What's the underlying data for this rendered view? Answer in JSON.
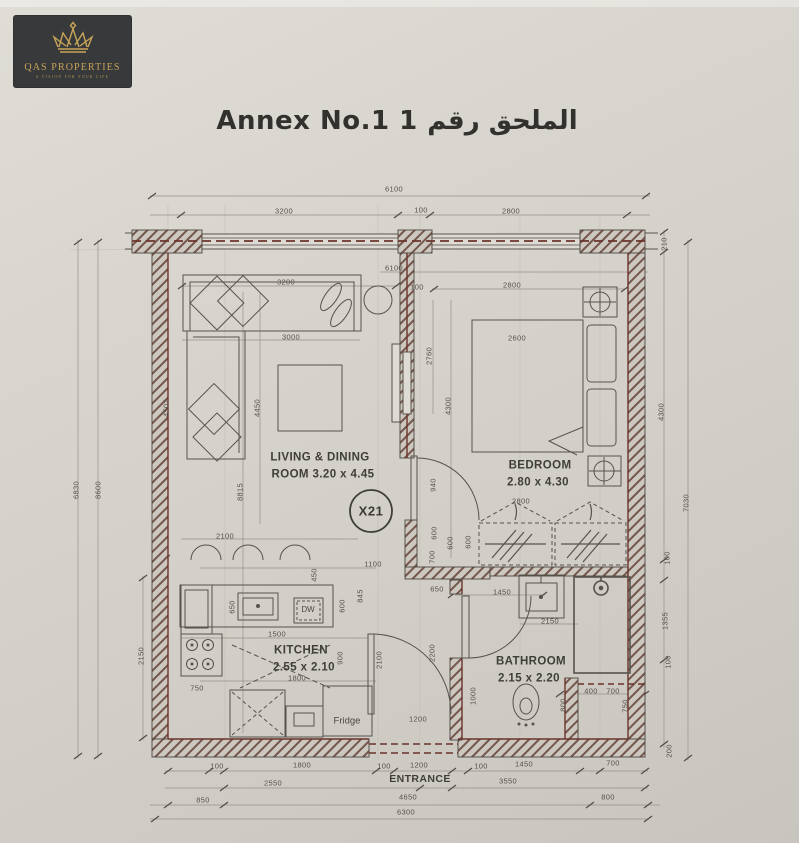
{
  "logo": {
    "name": "QAS PROPERTIES",
    "tagline": "A VISION FOR YOUR LIFE"
  },
  "title": "Annex No.1 1 الملحق رقم",
  "plan": {
    "unit_badge": "X21",
    "rooms": {
      "living": {
        "line1": "LIVING & DINING",
        "line2": "ROOM 3.20 x 4.45"
      },
      "bedroom": {
        "line1": "BEDROOM",
        "line2": "2.80 x 4.30"
      },
      "kitchen": {
        "line1": "KITCHEN",
        "line2": "2.55 x 2.10"
      },
      "bathroom": {
        "line1": "BATHROOM",
        "line2": "2.15 x 2.20"
      },
      "entrance": {
        "line1": "ENTRANCE"
      }
    },
    "appliances": {
      "dishwasher": "DW",
      "fridge": "Fridge"
    },
    "colors": {
      "paper": "#d5d2ca",
      "ink": "#4e4c46",
      "wall_accent": "#6b332b",
      "gold": "#c8a458",
      "logo_bg": "#37393b"
    },
    "dim_labels": [
      {
        "t": "6100",
        "x": 394,
        "y": 189
      },
      {
        "t": "3200",
        "x": 284,
        "y": 211
      },
      {
        "t": "100",
        "x": 421,
        "y": 210
      },
      {
        "t": "2800",
        "x": 511,
        "y": 211
      },
      {
        "t": "6830",
        "x": 76,
        "y": 490,
        "r": 1
      },
      {
        "t": "8600",
        "x": 98,
        "y": 490,
        "r": 1
      },
      {
        "t": "4502",
        "x": 166,
        "y": 408,
        "r": 1
      },
      {
        "t": "2150",
        "x": 141,
        "y": 656,
        "r": 1
      },
      {
        "t": "210",
        "x": 664,
        "y": 244,
        "r": 1
      },
      {
        "t": "4300",
        "x": 661,
        "y": 412,
        "r": 1
      },
      {
        "t": "7030",
        "x": 686,
        "y": 503,
        "r": 1
      },
      {
        "t": "100",
        "x": 667,
        "y": 558,
        "r": 1
      },
      {
        "t": "1355",
        "x": 665,
        "y": 621,
        "r": 1
      },
      {
        "t": "100",
        "x": 668,
        "y": 662,
        "r": 1
      },
      {
        "t": "200",
        "x": 669,
        "y": 751,
        "r": 1
      },
      {
        "t": "100",
        "x": 217,
        "y": 766
      },
      {
        "t": "1800",
        "x": 302,
        "y": 765
      },
      {
        "t": "100",
        "x": 384,
        "y": 766
      },
      {
        "t": "1200",
        "x": 419,
        "y": 765
      },
      {
        "t": "100",
        "x": 481,
        "y": 766
      },
      {
        "t": "1450",
        "x": 524,
        "y": 764
      },
      {
        "t": "700",
        "x": 613,
        "y": 763
      },
      {
        "t": "2550",
        "x": 273,
        "y": 783
      },
      {
        "t": "3550",
        "x": 508,
        "y": 781
      },
      {
        "t": "850",
        "x": 203,
        "y": 800
      },
      {
        "t": "4650",
        "x": 408,
        "y": 797
      },
      {
        "t": "800",
        "x": 608,
        "y": 797
      },
      {
        "t": "6300",
        "x": 406,
        "y": 812
      },
      {
        "t": "6100",
        "x": 394,
        "y": 268
      },
      {
        "t": "100",
        "x": 417,
        "y": 287
      },
      {
        "t": "2800",
        "x": 512,
        "y": 285
      },
      {
        "t": "3200",
        "x": 286,
        "y": 282
      },
      {
        "t": "3000",
        "x": 291,
        "y": 337
      },
      {
        "t": "4450",
        "x": 257,
        "y": 408,
        "r": 1
      },
      {
        "t": "8815",
        "x": 240,
        "y": 492,
        "r": 1
      },
      {
        "t": "2600",
        "x": 517,
        "y": 338
      },
      {
        "t": "2760",
        "x": 429,
        "y": 356,
        "r": 1
      },
      {
        "t": "4300",
        "x": 448,
        "y": 406,
        "r": 1
      },
      {
        "t": "940",
        "x": 433,
        "y": 485,
        "r": 1
      },
      {
        "t": "2800",
        "x": 521,
        "y": 501
      },
      {
        "t": "600",
        "x": 468,
        "y": 542,
        "r": 1
      },
      {
        "t": "2100",
        "x": 225,
        "y": 536
      },
      {
        "t": "1100",
        "x": 373,
        "y": 564
      },
      {
        "t": "450",
        "x": 314,
        "y": 575,
        "r": 1
      },
      {
        "t": "650",
        "x": 232,
        "y": 607,
        "r": 1
      },
      {
        "t": "845",
        "x": 360,
        "y": 596,
        "r": 1
      },
      {
        "t": "600",
        "x": 342,
        "y": 606,
        "r": 1
      },
      {
        "t": "1500",
        "x": 277,
        "y": 634
      },
      {
        "t": "900",
        "x": 340,
        "y": 658,
        "r": 1
      },
      {
        "t": "2100",
        "x": 379,
        "y": 660,
        "r": 1
      },
      {
        "t": "1800",
        "x": 297,
        "y": 678
      },
      {
        "t": "750",
        "x": 197,
        "y": 688
      },
      {
        "t": "600",
        "x": 434,
        "y": 533,
        "r": 1
      },
      {
        "t": "600",
        "x": 450,
        "y": 543,
        "r": 1
      },
      {
        "t": "700",
        "x": 432,
        "y": 557,
        "r": 1
      },
      {
        "t": "650",
        "x": 437,
        "y": 589
      },
      {
        "t": "1450",
        "x": 502,
        "y": 592
      },
      {
        "t": "2150",
        "x": 550,
        "y": 621
      },
      {
        "t": "2200",
        "x": 432,
        "y": 653,
        "r": 1
      },
      {
        "t": "1000",
        "x": 473,
        "y": 696,
        "r": 1
      },
      {
        "t": "1200",
        "x": 418,
        "y": 719
      },
      {
        "t": "800",
        "x": 563,
        "y": 705,
        "r": 1
      },
      {
        "t": "400",
        "x": 591,
        "y": 691
      },
      {
        "t": "700",
        "x": 613,
        "y": 691
      },
      {
        "t": "750",
        "x": 625,
        "y": 706,
        "r": 1
      }
    ]
  }
}
